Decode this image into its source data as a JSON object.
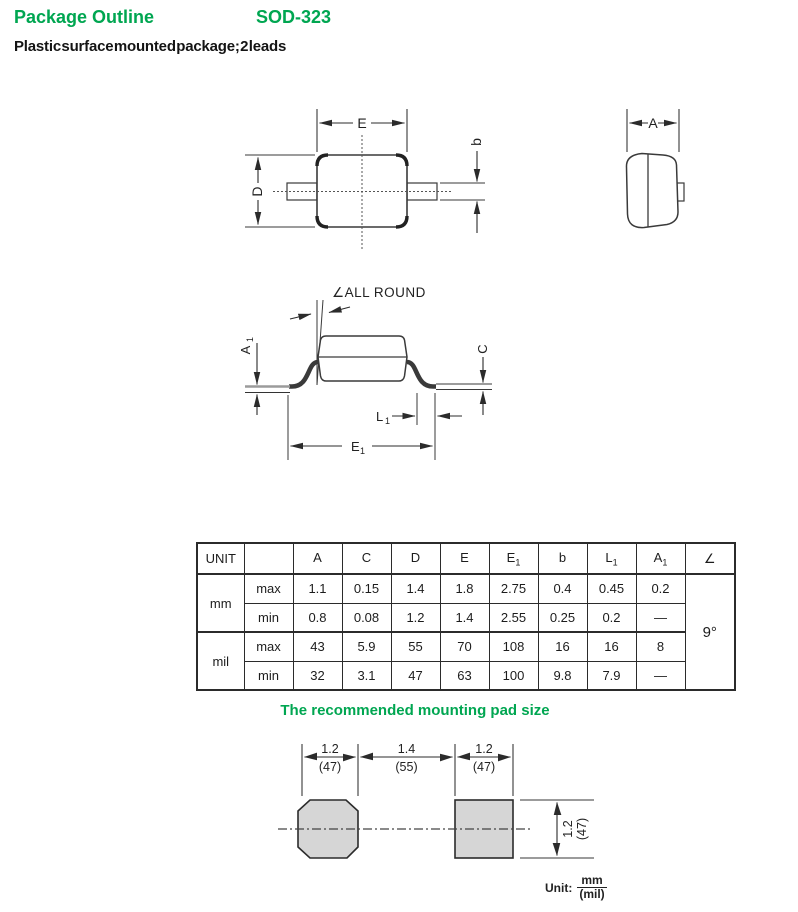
{
  "header": {
    "title": "Package Outline",
    "package_name": "SOD-323",
    "subtitle": "Plastic surface mounted package; 2 leads"
  },
  "colors": {
    "accent_green": "#00a651",
    "line": "#2b2b2b",
    "pad_fill": "#d6d6d6"
  },
  "labels": {
    "top_view": {
      "E": "E",
      "D": "D",
      "b": "b"
    },
    "side_view": {
      "A": "A"
    },
    "front_view": {
      "all_round": "∠ALL ROUND",
      "A1": {
        "t": "A",
        "s": "1"
      },
      "C": "C",
      "L1": {
        "t": "L",
        "s": "1"
      },
      "E1": {
        "t": "E",
        "s": "1"
      }
    }
  },
  "table": {
    "header": {
      "unit": "UNIT",
      "blank": "",
      "cols": [
        {
          "t": "A"
        },
        {
          "t": "C"
        },
        {
          "t": "D"
        },
        {
          "t": "E"
        },
        {
          "t": "E",
          "s": "1"
        },
        {
          "t": "b"
        },
        {
          "t": "L",
          "s": "1"
        },
        {
          "t": "A",
          "s": "1"
        }
      ],
      "angle": "∠"
    },
    "units": [
      "mm",
      "mil"
    ],
    "rows": [
      {
        "limit": "max",
        "values": [
          "1.1",
          "0.15",
          "1.4",
          "1.8",
          "2.75",
          "0.4",
          "0.45",
          "0.2"
        ]
      },
      {
        "limit": "min",
        "values": [
          "0.8",
          "0.08",
          "1.2",
          "1.4",
          "2.55",
          "0.25",
          "0.2",
          "—"
        ]
      },
      {
        "limit": "max",
        "values": [
          "43",
          "5.9",
          "55",
          "70",
          "108",
          "16",
          "16",
          "8"
        ]
      },
      {
        "limit": "min",
        "values": [
          "32",
          "3.1",
          "47",
          "63",
          "100",
          "9.8",
          "7.9",
          "—"
        ]
      }
    ],
    "angle_value": "9°"
  },
  "mounting_pad": {
    "heading": "The recommended mounting pad size",
    "dims_top": [
      {
        "mm": "1.2",
        "mil": "(47)"
      },
      {
        "mm": "1.4",
        "mil": "(55)"
      },
      {
        "mm": "1.2",
        "mil": "(47)"
      }
    ],
    "dim_side": {
      "mm": "1.2",
      "mil": "(47)"
    },
    "unit_note": {
      "label": "Unit:",
      "numerator": "mm",
      "denominator": "(mil)"
    }
  }
}
